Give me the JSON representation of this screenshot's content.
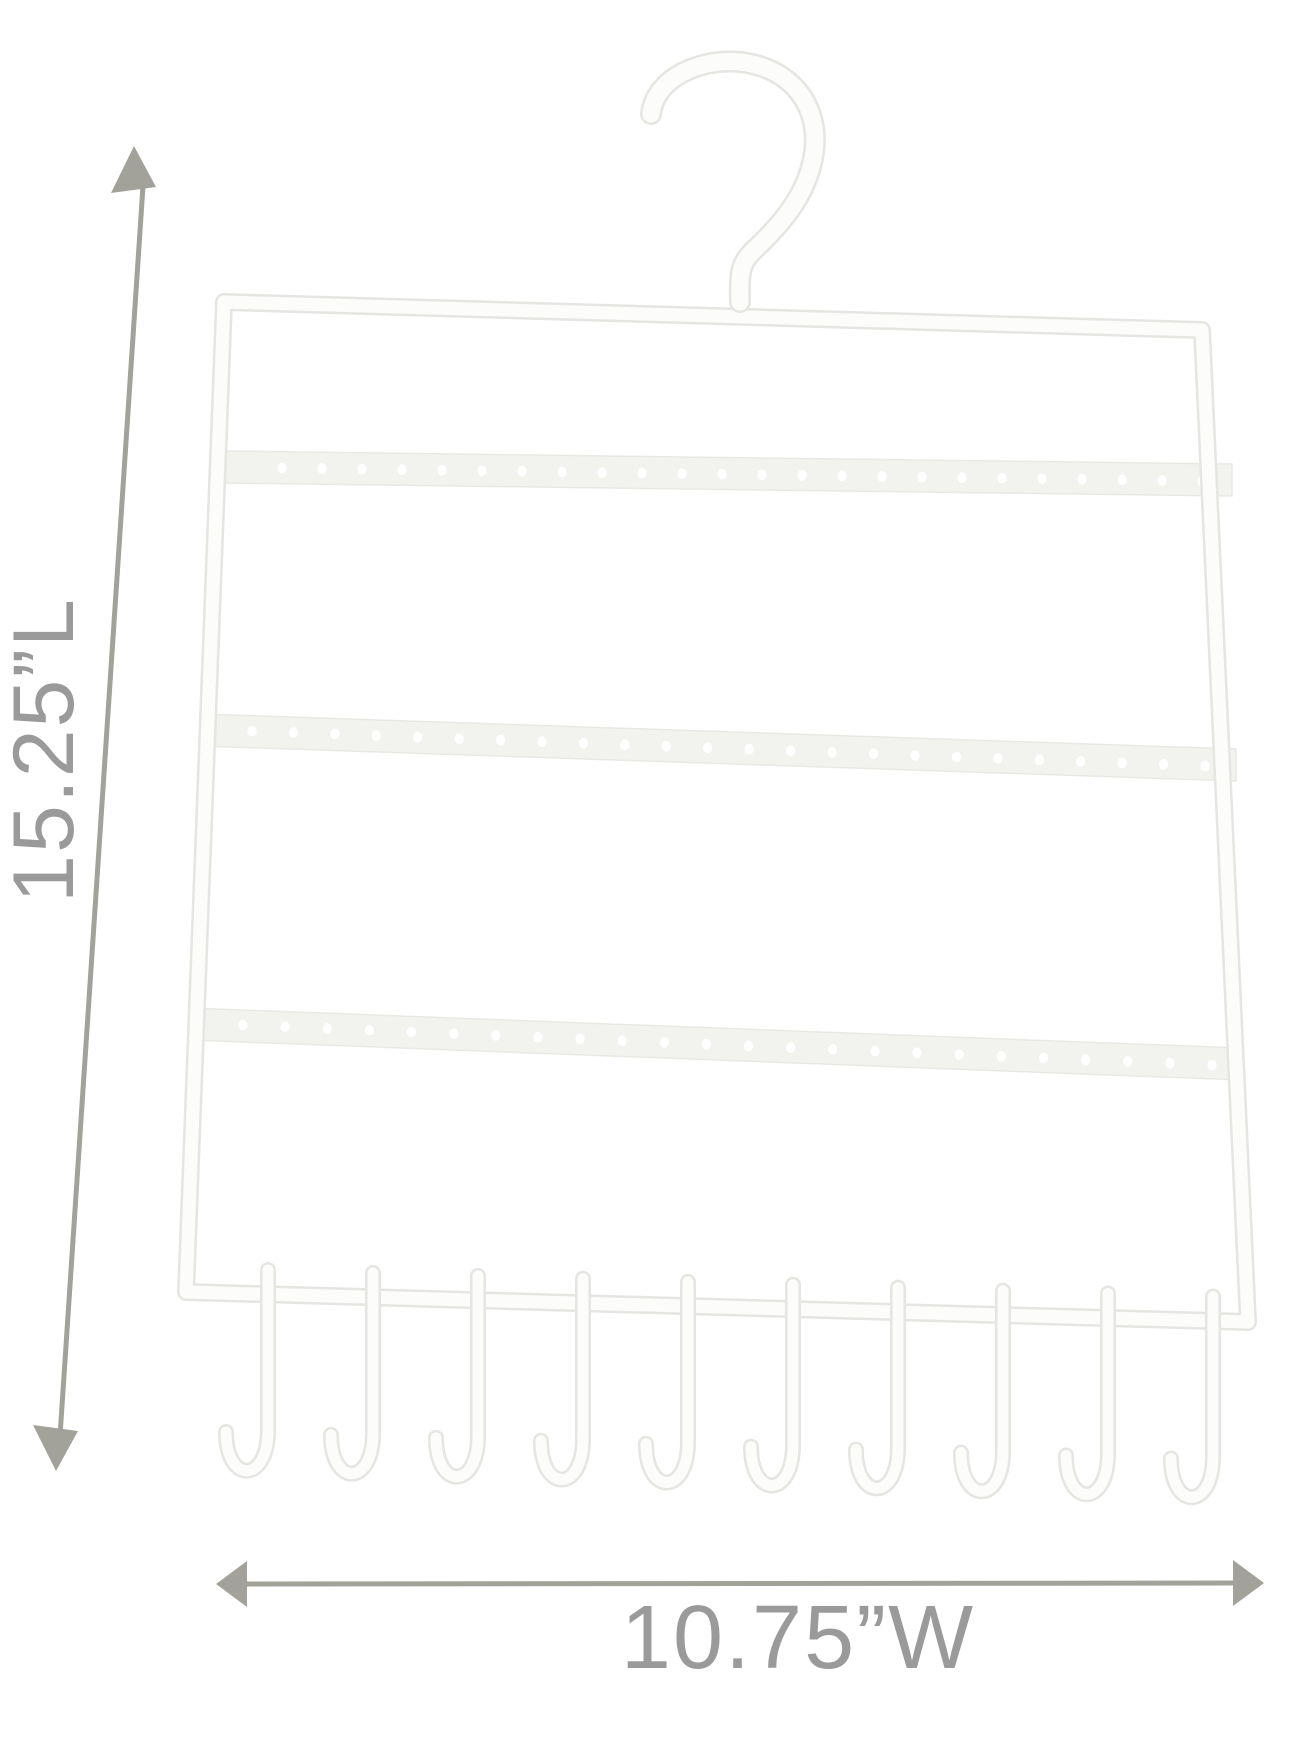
{
  "image": {
    "description": "White metal jewelry organizer hanger (earring holes and necklace hooks) shown on a white background with product dimension annotations",
    "background_color": "#ffffff"
  },
  "dimensions": {
    "height_label": "15.25”L",
    "width_label": "10.75”W",
    "line_color": "#a2a29a",
    "label_color": "#9a9a9a"
  },
  "hanger": {
    "wire_fill": "#fcfcfa",
    "wire_edge": "#e5e5e1",
    "strip_fill": "#f2f2ef",
    "strip_edge": "#e9e9e4",
    "hole_color": "#ffffff",
    "top_hook_count": 1,
    "earring_bars": 3,
    "holes_per_bar": 24,
    "bottom_hooks": 10
  }
}
